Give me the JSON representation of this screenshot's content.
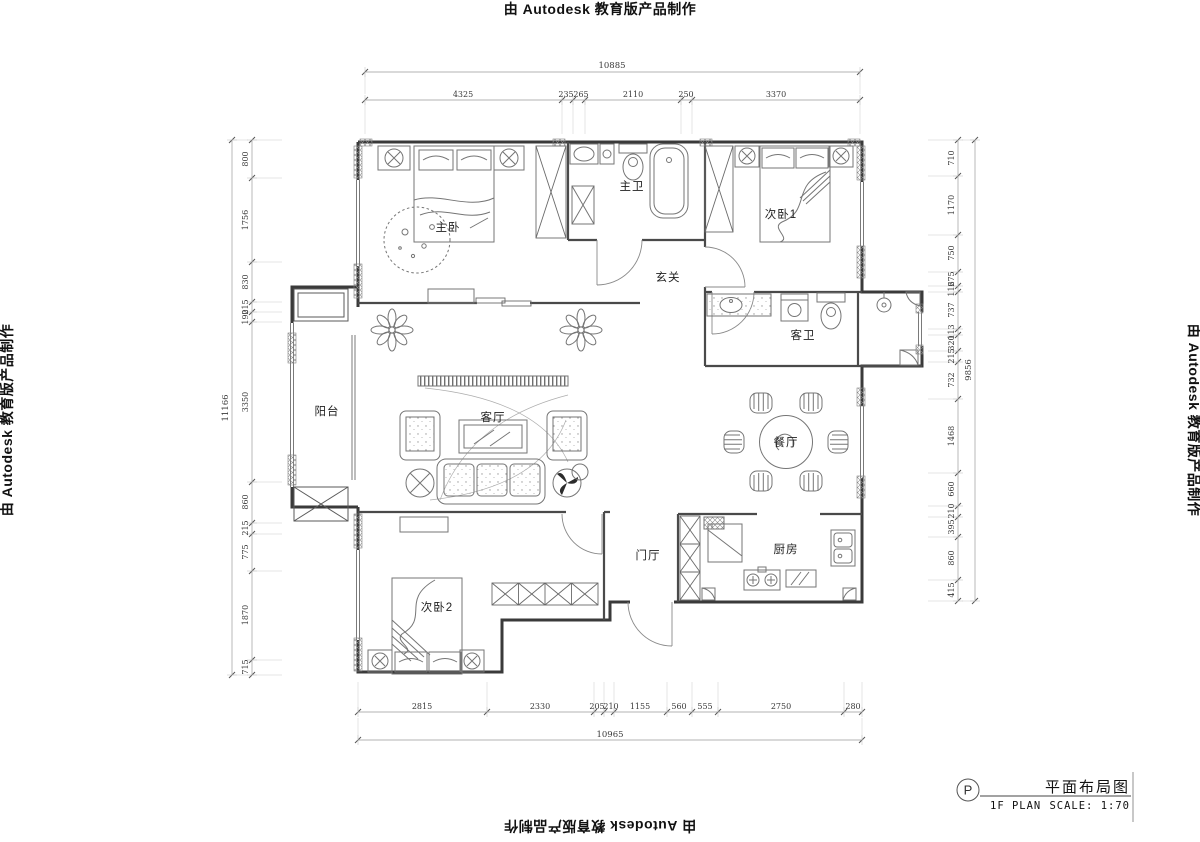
{
  "stamp": {
    "text": "由 Autodesk 教育版产品制作"
  },
  "title_block": {
    "marker": "P",
    "title": "平面布局图",
    "plan_label": "1F PLAN",
    "scale_label": "SCALE: 1:70"
  },
  "rooms": {
    "master_bedroom": "主卧",
    "master_bath": "主卫",
    "bedroom_2": "次卧1",
    "hallway": "玄关",
    "guest_bath": "客卫",
    "balcony": "阳台",
    "living_room": "客厅",
    "dining_room": "餐厅",
    "foyer": "门厅",
    "kitchen": "厨房",
    "bedroom_3": "次卧2"
  },
  "dimensions": {
    "top": {
      "overall": "10885",
      "segments": [
        "4325",
        "235",
        "265",
        "2110",
        "250",
        "3370"
      ]
    },
    "bottom": {
      "overall": "10965",
      "segments": [
        "2815",
        "2330",
        "205",
        "210",
        "1155",
        "560",
        "555",
        "2750",
        "280"
      ]
    },
    "left": {
      "overall": "11166",
      "segments": [
        "800",
        "1756",
        "830",
        "215",
        "190",
        "3350",
        "860",
        "215",
        "775",
        "1870",
        "715"
      ]
    },
    "right": {
      "overall": "9856",
      "segments": [
        "710",
        "1170",
        "750",
        "275",
        "116",
        "737",
        "113",
        "320",
        "215",
        "732",
        "1468",
        "660",
        "210",
        "395",
        "860",
        "415"
      ]
    }
  }
}
